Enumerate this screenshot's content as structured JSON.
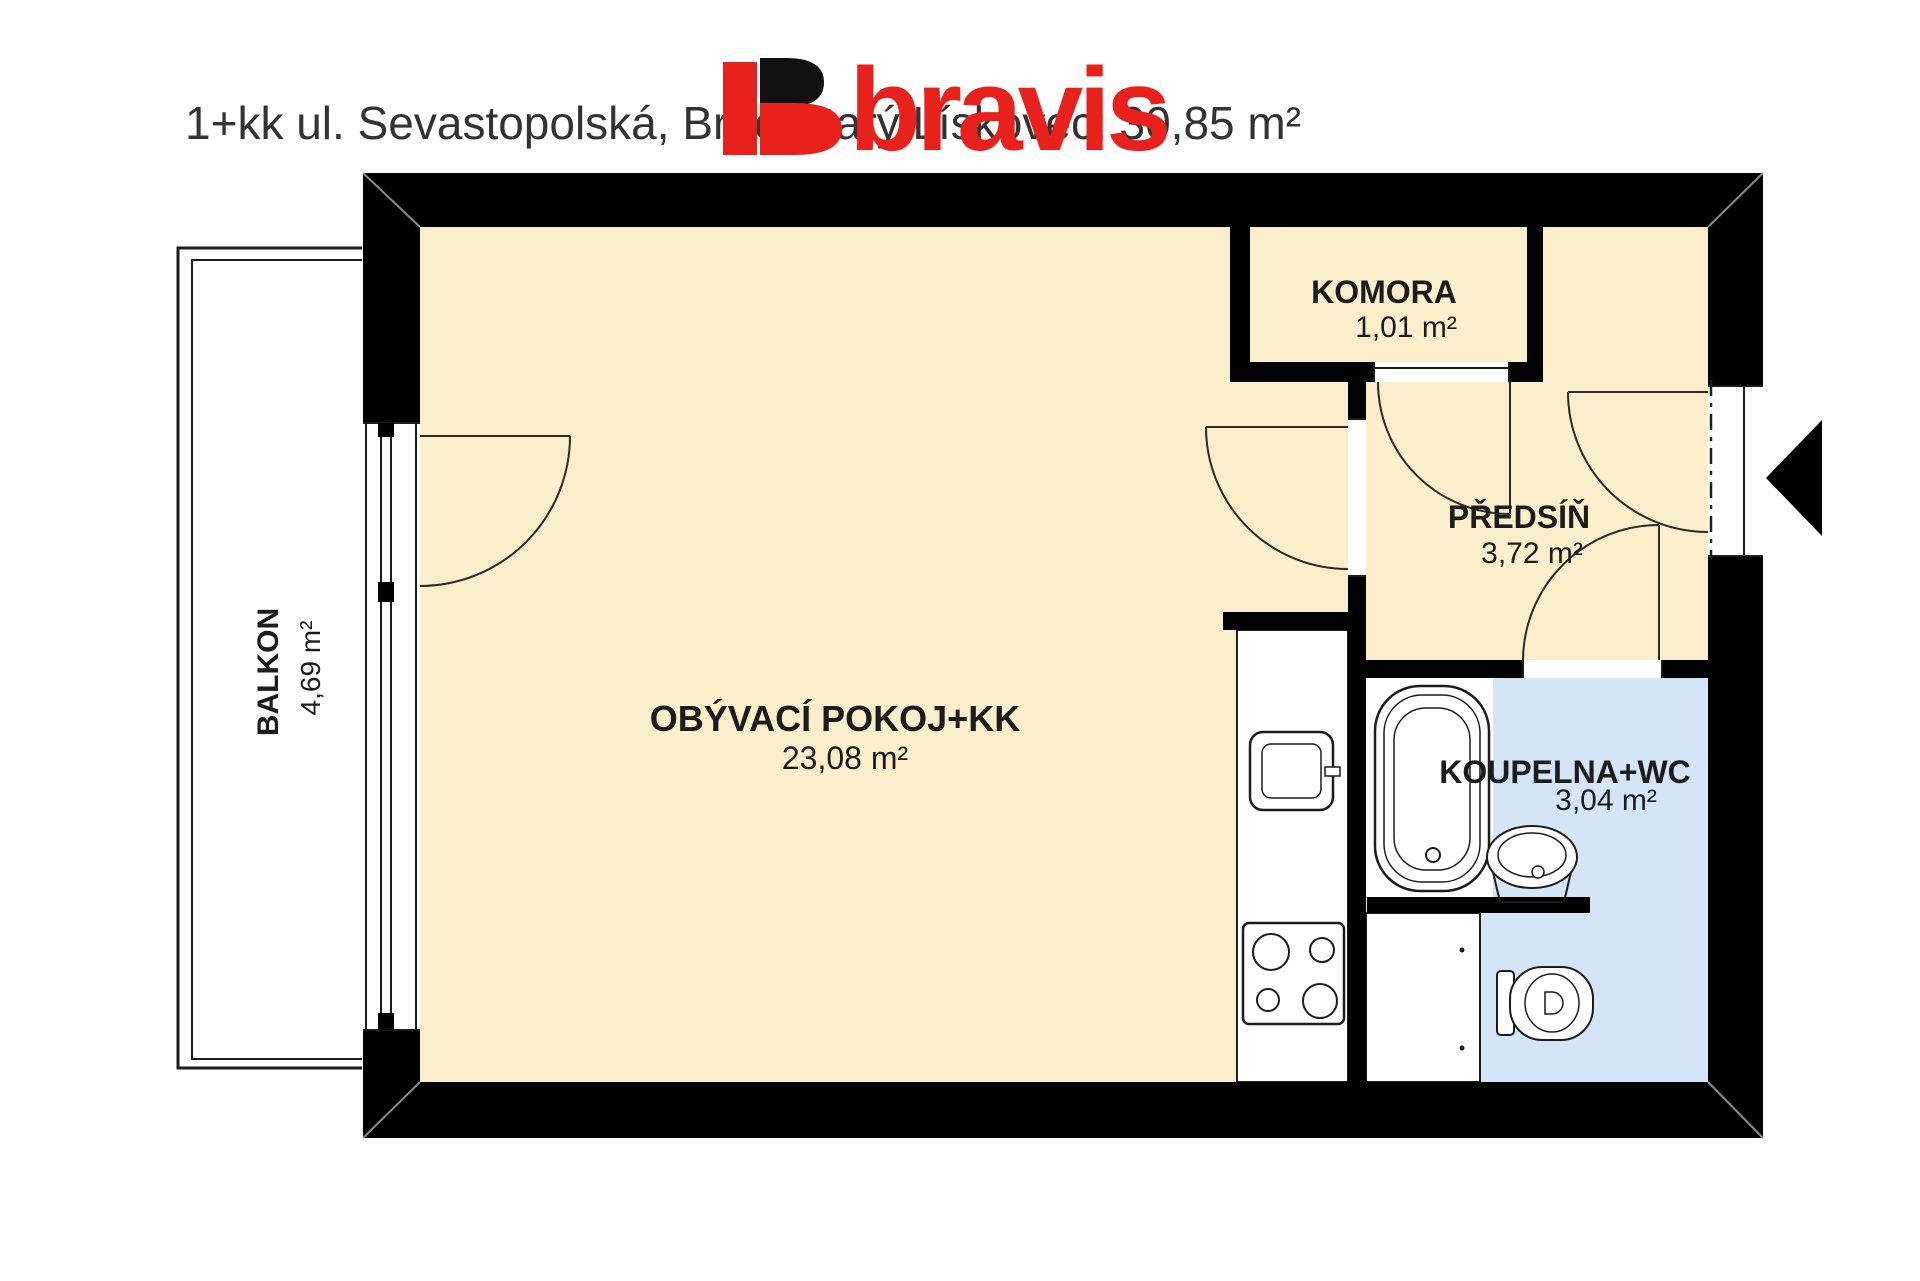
{
  "title": "1+kk ul. Sevastopolská, Brno Starý Lískovec; 30,85 m²",
  "logo": {
    "text": "bravis"
  },
  "rooms": {
    "living": {
      "name": "OBÝVACÍ POKOJ+KK",
      "area": "23,08 m²"
    },
    "komora": {
      "name": "KOMORA",
      "area": "1,01 m²"
    },
    "predsin": {
      "name": "PŘEDSÍŇ",
      "area": "3,72 m²"
    },
    "koupelna": {
      "name": "KOUPELNA+WC",
      "area": "3,04 m²"
    },
    "balkon": {
      "name": "BALKON",
      "area": "4,69 m²"
    }
  },
  "colors": {
    "room_fill": "#fbefcb",
    "bath_fill": "#d4e5f7",
    "wall": "#000000",
    "brand_red": "#e8211c",
    "logo_black": "#111111",
    "title_text": "#333333"
  }
}
